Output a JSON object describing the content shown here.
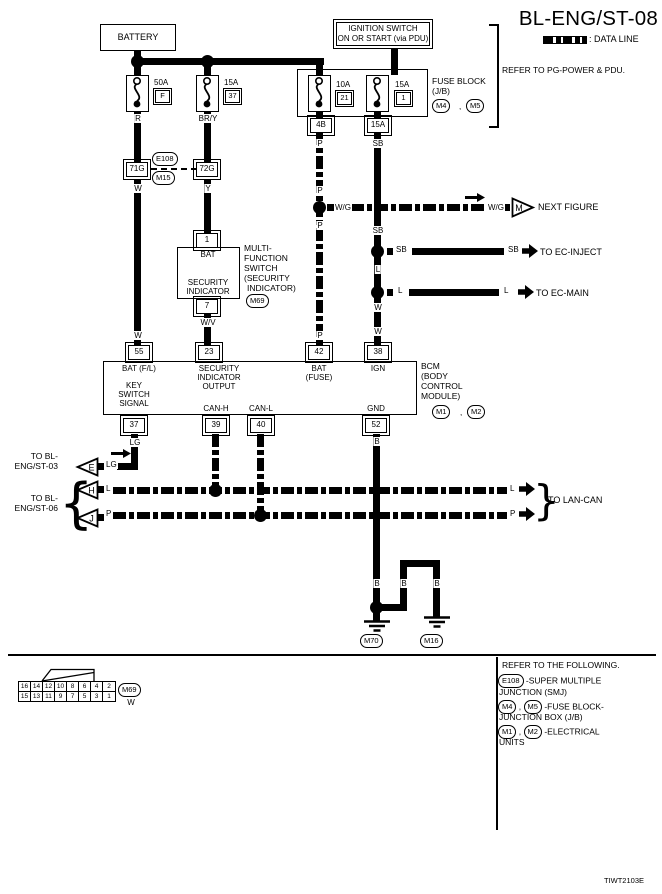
{
  "title": "BL-ENG/ST-08",
  "legend_label": ": DATA LINE",
  "refer_pg": "REFER TO PG-POWER & PDU.",
  "comma": ",",
  "battery": "BATTERY",
  "ignition1": "IGNITION SWITCH",
  "ignition2": "ON OR START (via PDU)",
  "fuse1_amp": "50A",
  "fuse1_id": "F",
  "fuse2_amp": "15A",
  "fuse2_id": "37",
  "fuse3_amp": "10A",
  "fuse3_id": "21",
  "fuse4_amp": "15A",
  "fuse4_id": "1",
  "fuse_block1": "FUSE BLOCK",
  "fuse_block2": "(J/B)",
  "ref_m4": "M4",
  "ref_m5": "M5",
  "conn_4b": "4B",
  "conn_15a": "15A",
  "smj_left": "71G",
  "smj_right": "72G",
  "ref_e108": "E108",
  "ref_m15": "M15",
  "wire": {
    "r": "R",
    "bry": "BR/Y",
    "w": "W",
    "y": "Y",
    "wv": "W/V",
    "p": "P",
    "sb": "SB",
    "l": "L",
    "lg": "LG",
    "b": "B",
    "wg": "W/G"
  },
  "mfs": {
    "pin1": "1",
    "pin7": "7",
    "bat": "BAT",
    "sec1": "SECURITY",
    "sec2": "INDICATOR",
    "side1": "MULTI-",
    "side2": "FUNCTION",
    "side3": "SWITCH",
    "side4": "(SECURITY",
    "side5": "INDICATOR)",
    "ref": "M69"
  },
  "bcm": {
    "p55": "55",
    "p23": "23",
    "p42": "42",
    "p38": "38",
    "p37": "37",
    "p39": "39",
    "p40": "40",
    "p52": "52",
    "bat_fl": "BAT (F/L)",
    "sec1": "SECURITY",
    "sec2": "INDICATOR",
    "sec3": "OUTPUT",
    "bat1": "BAT",
    "bat2": "(FUSE)",
    "ign": "IGN",
    "key1": "KEY",
    "key2": "SWITCH",
    "key3": "SIGNAL",
    "canh": "CAN-H",
    "canl": "CAN-L",
    "gnd": "GND",
    "side1": "BCM",
    "side2": "(BODY",
    "side3": "CONTROL",
    "side4": "MODULE)",
    "ref_m1": "M1",
    "ref_m2": "M2"
  },
  "dest": {
    "m": "M",
    "next_figure": "NEXT FIGURE",
    "ec_inject": "TO EC-INJECT",
    "ec_main": "TO EC-MAIN",
    "e": "E",
    "h": "H",
    "j": "J",
    "st03a": "TO BL-",
    "st03b": "ENG/ST-03",
    "st06a": "TO BL-",
    "st06b": "ENG/ST-06",
    "lan_can": "TO LAN-CAN",
    "brace_l": "{",
    "brace_r": "}"
  },
  "ground": {
    "m70": "M70",
    "m16": "M16"
  },
  "view": {
    "top": [
      "16",
      "14",
      "12",
      "10",
      "8",
      "6",
      "4",
      "2"
    ],
    "bottom": [
      "15",
      "13",
      "11",
      "9",
      "7",
      "5",
      "3",
      "1"
    ],
    "ref": "M69",
    "color": "W"
  },
  "footer": {
    "title": "REFER TO THE FOLLOWING.",
    "e108": "E108",
    "t1a": "-SUPER MULTIPLE",
    "t1b": "JUNCTION (SMJ)",
    "m4": "M4",
    "m5": "M5",
    "t2a": "-FUSE BLOCK-",
    "t2b": "JUNCTION BOX (J/B)",
    "m1": "M1",
    "m2": "M2",
    "t3a": "-ELECTRICAL",
    "t3b": "UNITS"
  },
  "code": "TIWT2103E"
}
